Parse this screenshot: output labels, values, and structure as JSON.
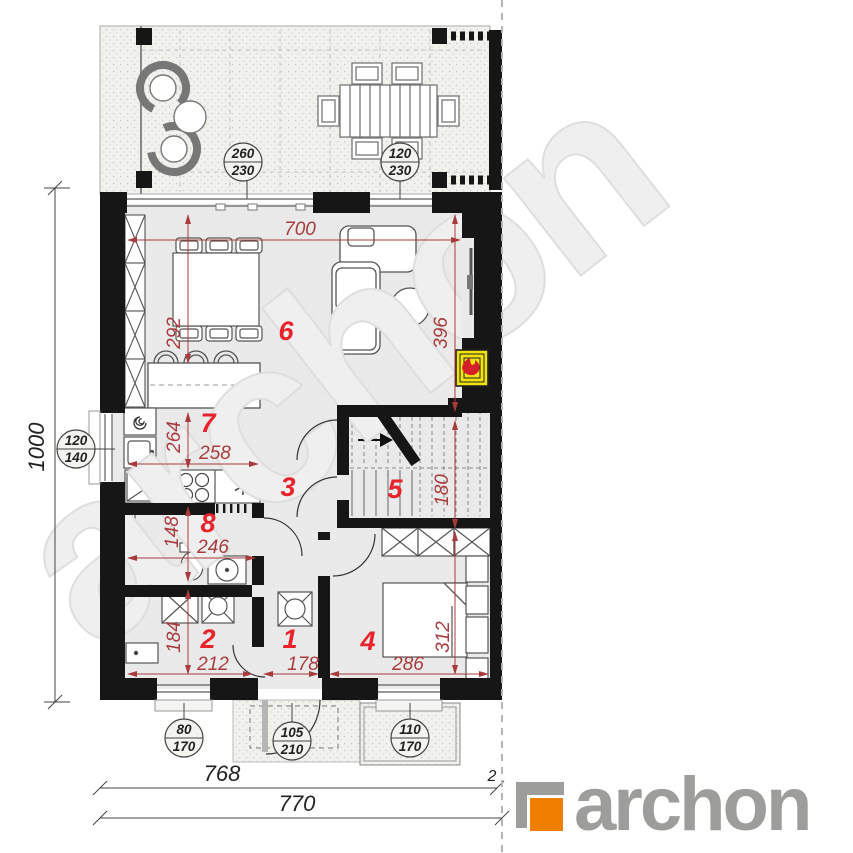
{
  "watermark": {
    "text": "archon"
  },
  "logo": {
    "brand": "archon",
    "orange": "#f07f00",
    "gray": "#9d9d9c"
  },
  "colors": {
    "wall": "#161616",
    "floor": "#eaeaea",
    "dim_red": "#a83c3c",
    "room_red": "#e8232b",
    "fireplace_yellow": "#f2e30e",
    "flame_red": "#d4202a"
  },
  "rooms": [
    {
      "number": "1"
    },
    {
      "number": "2"
    },
    {
      "number": "3"
    },
    {
      "number": "4"
    },
    {
      "number": "5"
    },
    {
      "number": "6"
    },
    {
      "number": "7"
    },
    {
      "number": "8"
    }
  ],
  "red_dims": {
    "d700": "700",
    "d292": "292",
    "d396": "396",
    "d264": "264",
    "d258": "258",
    "d148": "148",
    "d246": "246",
    "d180": "180",
    "d184": "184",
    "d212": "212",
    "d178": "178",
    "d286": "286",
    "d312": "312"
  },
  "window_tags": {
    "terrace_slider": {
      "w": "260",
      "h": "230"
    },
    "terrace_window": {
      "w": "120",
      "h": "230"
    },
    "kitchen_window": {
      "w": "120",
      "h": "140"
    },
    "utility_window": {
      "w": "80",
      "h": "170"
    },
    "entry_door": {
      "w": "105",
      "h": "210"
    },
    "bedroom_window": {
      "w": "110",
      "h": "170"
    }
  },
  "outer_dims": {
    "left_height": "1000",
    "bottom_inner": "768",
    "bottom_outer": "770",
    "right_gap": "2"
  }
}
